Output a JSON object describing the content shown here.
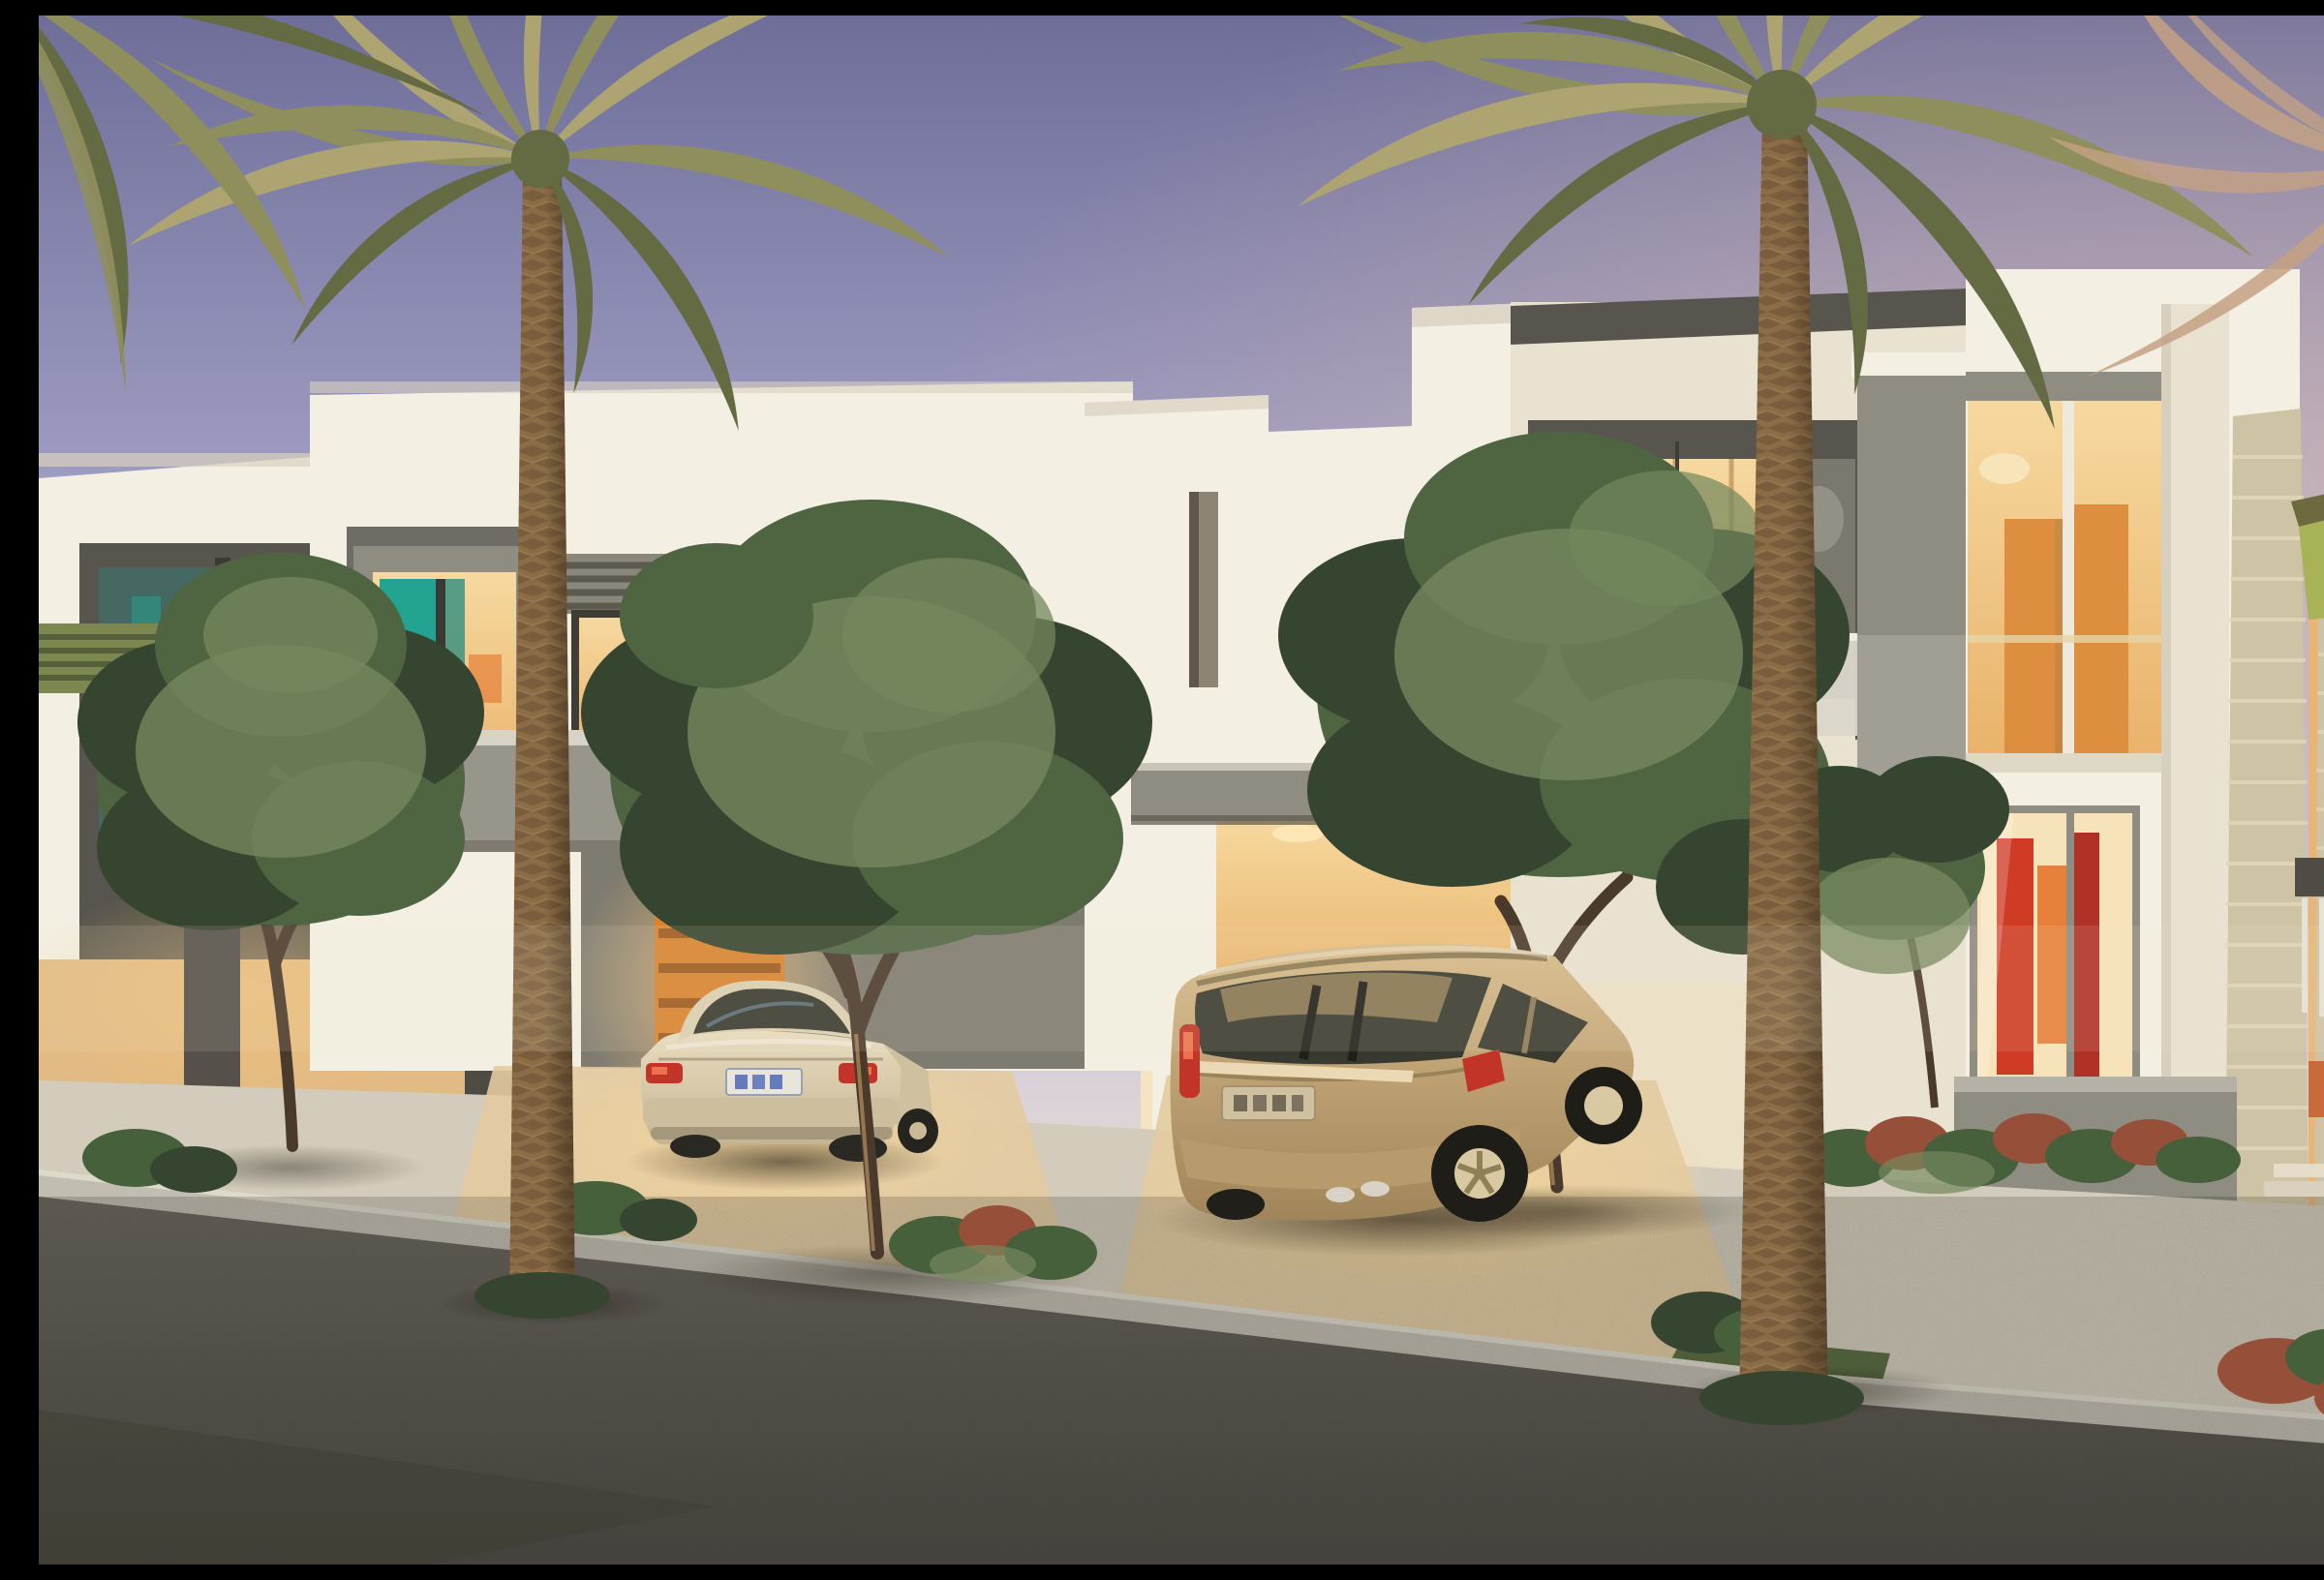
{
  "scene": {
    "description": "Dusk architectural rendering of a row of modern white two-storey townhouses with warm interior lighting, two tall date palms, green ornamental trees and shrubs, a champagne sedan and a gold family van parked in lit carports, light paved driveways and sidewalk, and a dark asphalt street in the foreground under a violet evening sky.",
    "time_of_day": "dusk",
    "objects": [
      {
        "name": "evening-sky",
        "detail": "violet-to-warm gradient sky"
      },
      {
        "name": "townhouse-far-left",
        "detail": "white facade, dark gray window bay, green louver canopy, warm-lit ground wall with wooden slat screen"
      },
      {
        "name": "townhouse-left",
        "detail": "gray boxed bay window with teal and red artwork inside, louvered corner window, gray balcony band"
      },
      {
        "name": "townhouse-center",
        "detail": "stepped white parapet, narrow slot window, lit carport with concrete beam"
      },
      {
        "name": "townhouse-center-right",
        "detail": "dark framed balcony box with warm glass doors, pendant lamp, frosted balustrade, concrete side wall"
      },
      {
        "name": "townhouse-right",
        "detail": "two-storey glazing with orange wardrobe panels upstairs and red abstract art downstairs, curved wall lamp, stone clad pillar, gray fence wall"
      },
      {
        "name": "villa-fragment-far-right",
        "detail": "lime-green soffit canopy, stone pillar, balcony railing, warm glow"
      },
      {
        "name": "date-palm-left",
        "detail": "tall textured trunk, olive frond crown"
      },
      {
        "name": "date-palm-right",
        "detail": "taller palm in front of right houses"
      },
      {
        "name": "palm-fronds-top-left-corner",
        "detail": "dark fronds entering frame"
      },
      {
        "name": "palm-fronds-far-right",
        "detail": "pinkish dry fronds at frame edge"
      },
      {
        "name": "ornamental-tree-left",
        "detail": "round green tree in front of dark bay"
      },
      {
        "name": "ornamental-tree-center",
        "detail": "large green tree in front of gray garage wall"
      },
      {
        "name": "ornamental-tree-right",
        "detail": "large green tree in front of balcony house"
      },
      {
        "name": "sedan-car",
        "detail": "champagne sedan parked in left carport, rear view, red taillights, white plate with illegible blue characters"
      },
      {
        "name": "minivan-car",
        "detail": "gold family van parked in center carport, rear three-quarter view, beige plate with illegible dark characters, alloy wheels"
      },
      {
        "name": "driveways",
        "detail": "warm-lit paved aprons"
      },
      {
        "name": "sidewalk",
        "detail": "light stone pavement with curb"
      },
      {
        "name": "street",
        "detail": "dark speckled asphalt"
      },
      {
        "name": "shrub-beds",
        "detail": "green and rust-red ground cover"
      }
    ],
    "license_plates": [
      {
        "vehicle": "sedan",
        "legible": false,
        "style": "white plate, blue characters"
      },
      {
        "vehicle": "minivan",
        "legible": false,
        "style": "beige plate, dark characters"
      }
    ]
  },
  "palette": {
    "sky_top": "#6e6e99",
    "sky_mid": "#9b99bf",
    "sky_soft": "#bcb8d6",
    "sky_horizon_cool": "#d8d0d8",
    "sky_horizon_warm": "#f0e5d1",
    "wall_white": "#f3efe3",
    "wall_cream": "#e9e2d1",
    "wall_shade": "#d8d0bf",
    "accent_dark": "#57554d",
    "accent_mid": "#8f8c81",
    "accent_light": "#b5b1a4",
    "band_gray": "#98958a",
    "garage_wall": "#7e7b70",
    "glow_warm": "#f6d9a0",
    "glow_amber": "#e9b26a",
    "glow_deep": "#d1934c",
    "orange_door": "#d9832f",
    "orange_panel": "#dd8f3f",
    "teal_art": "#23a392",
    "red_art": "#cf3b24",
    "orange_art": "#e6803a",
    "purple_accent": "#8a7ab8",
    "palm_frond": "#8f8f5e",
    "palm_frond_light": "#ada471",
    "palm_frond_dark": "#646a41",
    "palm_trunk": "#8a6c46",
    "palm_trunk_dark": "#6f5336",
    "pink_frond": "#c4a183",
    "tree_dark": "#36452f",
    "tree_mid": "#4f6542",
    "tree_light": "#74875c",
    "trunk_brown": "#4a3a2c",
    "sidewalk": "#d3ccbc",
    "curb": "#c1bdb0",
    "driveway": "#e3cba0",
    "road": "#6e6a61",
    "road_dark": "#524f48",
    "grass": "#5d7045",
    "shrub_green": "#46603c",
    "shrub_red": "#96503a",
    "sedan_body": "#dcd0b2",
    "van_body": "#c2a577",
    "glass_dark": "#38392f",
    "taillight": "#c23428",
    "plate_light": "#e8e6da",
    "plate_blue": "#3a57b0",
    "stone": "#cfc3a5",
    "lime_canopy": "#a8b257"
  }
}
